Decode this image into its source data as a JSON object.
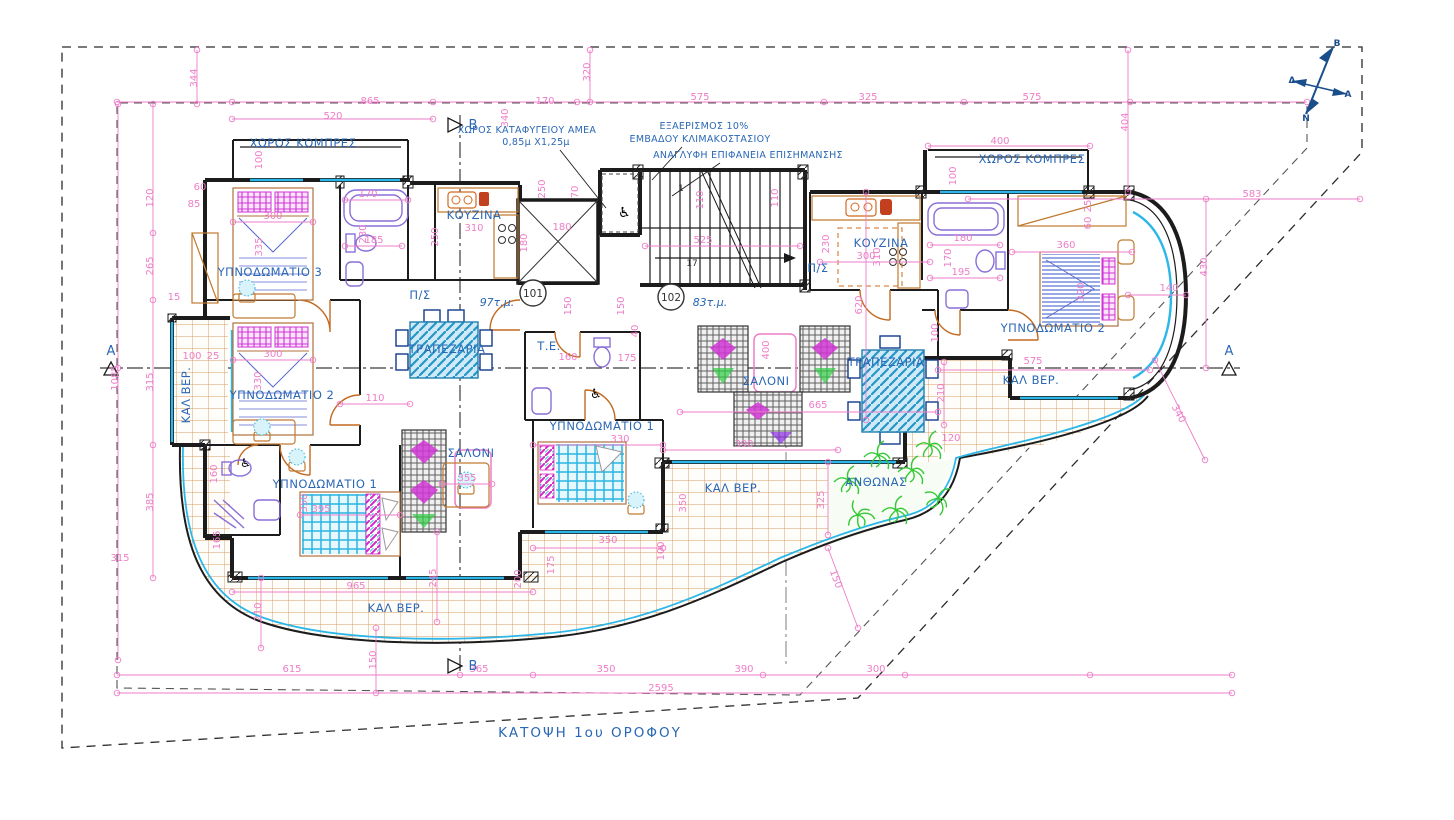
{
  "drawing_title": "ΚΑΤΟΨΗ 1ου ΟΡΟΦΟΥ",
  "apartments": [
    {
      "number": "101",
      "area_label": "97τ.μ."
    },
    {
      "number": "102",
      "area_label": "83τ.μ."
    }
  ],
  "colors": {
    "dimension_pink": "#ee7ec8",
    "label_blue": "#2a67b5",
    "wall_black": "#1c1c1c",
    "glazing_cyan": "#2cb7e8",
    "tile_tan": "#d49a62",
    "plant_green": "#34c934",
    "door_orange": "#c2691f",
    "furniture_magenta": "#cf35d4",
    "table_blue": "#2596c8",
    "compass_navy": "#1a4e8a"
  },
  "compass_letters": [
    {
      "t": "B",
      "x": 1337,
      "y": 46
    },
    {
      "t": "Δ",
      "x": 1292,
      "y": 83
    },
    {
      "t": "A",
      "x": 1348,
      "y": 97
    },
    {
      "t": "N",
      "x": 1306,
      "y": 121
    }
  ],
  "section_markers": [
    {
      "t": "B",
      "x": 473,
      "y": 129
    },
    {
      "t": "B",
      "x": 473,
      "y": 670
    },
    {
      "t": "A",
      "x": 111,
      "y": 355
    },
    {
      "t": "A",
      "x": 1229,
      "y": 355
    }
  ],
  "stair_labels": [
    {
      "t": "1",
      "x": 681,
      "y": 191
    },
    {
      "t": "17",
      "x": 692,
      "y": 266
    }
  ],
  "annotations": [
    {
      "t": "ΧΩΡΟΣ ΚΑΤΑΦΥΓΕΙΟΥ ΑΜΕΑ",
      "x": 527,
      "y": 133
    },
    {
      "t": "0,85μ Χ1,25μ",
      "x": 536,
      "y": 145
    },
    {
      "t": "ΕΞΑΕΡΙΣΜΟΣ 10%",
      "x": 704,
      "y": 129
    },
    {
      "t": "ΕΜΒΑΔΟΥ ΚΛΙΜΑΚΟΣΤΑΣΙΟΥ",
      "x": 700,
      "y": 142
    },
    {
      "t": "ΑΝΑΓΛΥΦΗ ΕΠΙΦΑΝΕΙΑ ΕΠΙΣΗΜΑΝΣΗΣ",
      "x": 748,
      "y": 158
    }
  ],
  "room_labels": [
    {
      "t": "ΧΩΡΟΣ ΚΟΜΠΡΕΣ",
      "x": 303,
      "y": 147
    },
    {
      "t": "ΧΩΡΟΣ ΚΟΜΠΡΕΣ",
      "x": 1032,
      "y": 163
    },
    {
      "t": "ΥΠΝΟΔΩΜΑΤΙΟ 3",
      "x": 270,
      "y": 276
    },
    {
      "t": "ΥΠΝΟΔΩΜΑΤΙΟ 2",
      "x": 282,
      "y": 399
    },
    {
      "t": "ΥΠΝΟΔΩΜΑΤΙΟ 1",
      "x": 325,
      "y": 488
    },
    {
      "t": "ΥΠΝΟΔΩΜΑΤΙΟ 1",
      "x": 602,
      "y": 430
    },
    {
      "t": "ΥΠΝΟΔΩΜΑΤΙΟ 2",
      "x": 1053,
      "y": 332
    },
    {
      "t": "ΚΟΥΖΙΝΑ",
      "x": 474,
      "y": 219
    },
    {
      "t": "ΚΟΥΖΙΝΑ",
      "x": 881,
      "y": 247
    },
    {
      "t": "ΤΡΑΠΕΖΑΡΙΑ",
      "x": 447,
      "y": 353
    },
    {
      "t": "ΤΡΑΠΕΖΑΡΙΑ",
      "x": 886,
      "y": 366
    },
    {
      "t": "ΣΑΛΟΝΙ",
      "x": 471,
      "y": 457
    },
    {
      "t": "ΣΑΛΟΝΙ",
      "x": 766,
      "y": 385
    },
    {
      "t": "ΚΑΛ ΒΕΡ.",
      "x": 190,
      "y": 395,
      "r": -90
    },
    {
      "t": "ΚΑΛ ΒΕΡ.",
      "x": 396,
      "y": 612
    },
    {
      "t": "ΚΑΛ ΒΕΡ.",
      "x": 733,
      "y": 492
    },
    {
      "t": "ΚΑΛ ΒΕΡ.",
      "x": 1031,
      "y": 384
    },
    {
      "t": "ΑΝΘΩΝΑΣ",
      "x": 876,
      "y": 486
    },
    {
      "t": "Τ.Ε.",
      "x": 549,
      "y": 350,
      "s": 10
    },
    {
      "t": "Π/Σ",
      "x": 420,
      "y": 299,
      "s": 9
    },
    {
      "t": "Π/Σ",
      "x": 818,
      "y": 272,
      "s": 9
    }
  ],
  "dimensions": [
    {
      "t": "865",
      "x": 370,
      "y": 104
    },
    {
      "t": "520",
      "x": 333,
      "y": 119
    },
    {
      "t": "344",
      "x": 197,
      "y": 78,
      "r": -90
    },
    {
      "t": "170",
      "x": 545,
      "y": 104
    },
    {
      "t": "340",
      "x": 508,
      "y": 118,
      "r": -90
    },
    {
      "t": "320",
      "x": 590,
      "y": 72,
      "r": -90
    },
    {
      "t": "575",
      "x": 700,
      "y": 100
    },
    {
      "t": "325",
      "x": 868,
      "y": 100
    },
    {
      "t": "575",
      "x": 1032,
      "y": 100
    },
    {
      "t": "400",
      "x": 1000,
      "y": 144
    },
    {
      "t": "404",
      "x": 1128,
      "y": 122,
      "r": -90
    },
    {
      "t": "583",
      "x": 1252,
      "y": 197
    },
    {
      "t": "100",
      "x": 262,
      "y": 160,
      "r": -90
    },
    {
      "t": "100",
      "x": 956,
      "y": 176,
      "r": -90
    },
    {
      "t": "60",
      "x": 200,
      "y": 190,
      "s": 8.5
    },
    {
      "t": "85",
      "x": 194,
      "y": 207,
      "s": 8.5
    },
    {
      "t": "120",
      "x": 153,
      "y": 198,
      "r": -90
    },
    {
      "t": "265",
      "x": 153,
      "y": 266,
      "r": -90
    },
    {
      "t": "315",
      "x": 153,
      "y": 382,
      "r": -90
    },
    {
      "t": "385",
      "x": 153,
      "y": 502,
      "r": -90
    },
    {
      "t": "1085",
      "x": 118,
      "y": 378,
      "r": -90
    },
    {
      "t": "315",
      "x": 120,
      "y": 561
    },
    {
      "t": "170",
      "x": 368,
      "y": 197
    },
    {
      "t": "230",
      "x": 366,
      "y": 234,
      "r": -90
    },
    {
      "t": "185",
      "x": 374,
      "y": 243
    },
    {
      "t": "250",
      "x": 438,
      "y": 237,
      "r": -90
    },
    {
      "t": "310",
      "x": 474,
      "y": 231
    },
    {
      "t": "300",
      "x": 273,
      "y": 219
    },
    {
      "t": "335",
      "x": 262,
      "y": 247,
      "r": -90
    },
    {
      "t": "300",
      "x": 273,
      "y": 357
    },
    {
      "t": "330",
      "x": 261,
      "y": 381,
      "r": -90
    },
    {
      "t": "100",
      "x": 192,
      "y": 359,
      "s": 8.5
    },
    {
      "t": "25",
      "x": 213,
      "y": 359,
      "s": 8.5
    },
    {
      "t": "15",
      "x": 174,
      "y": 300,
      "s": 8.5
    },
    {
      "t": "110",
      "x": 375,
      "y": 401
    },
    {
      "t": "180",
      "x": 562,
      "y": 230
    },
    {
      "t": "180",
      "x": 527,
      "y": 243,
      "r": -90
    },
    {
      "t": "70",
      "x": 578,
      "y": 192,
      "r": -90
    },
    {
      "t": "250",
      "x": 545,
      "y": 189,
      "r": -90
    },
    {
      "t": "525",
      "x": 703,
      "y": 243
    },
    {
      "t": "110",
      "x": 703,
      "y": 200,
      "r": -90
    },
    {
      "t": "110",
      "x": 778,
      "y": 198,
      "r": -90
    },
    {
      "t": "150",
      "x": 571,
      "y": 306,
      "r": -90
    },
    {
      "t": "150",
      "x": 624,
      "y": 306,
      "r": -90
    },
    {
      "t": "160",
      "x": 568,
      "y": 360
    },
    {
      "t": "175",
      "x": 627,
      "y": 361
    },
    {
      "t": "40",
      "x": 638,
      "y": 331,
      "r": -90,
      "s": 8.5
    },
    {
      "t": "230",
      "x": 829,
      "y": 244,
      "r": -90
    },
    {
      "t": "300",
      "x": 866,
      "y": 259
    },
    {
      "t": "310",
      "x": 880,
      "y": 257,
      "r": -90
    },
    {
      "t": "620",
      "x": 862,
      "y": 305,
      "r": -90
    },
    {
      "t": "100",
      "x": 938,
      "y": 333,
      "r": -90
    },
    {
      "t": "195",
      "x": 961,
      "y": 275
    },
    {
      "t": "180",
      "x": 963,
      "y": 241
    },
    {
      "t": "170",
      "x": 951,
      "y": 258,
      "r": -90
    },
    {
      "t": "25",
      "x": 1091,
      "y": 206,
      "r": -90,
      "s": 8
    },
    {
      "t": "60",
      "x": 1091,
      "y": 223,
      "r": -90,
      "s": 8
    },
    {
      "t": "360",
      "x": 1066,
      "y": 248
    },
    {
      "t": "320",
      "x": 1084,
      "y": 292,
      "r": -90
    },
    {
      "t": "140",
      "x": 1169,
      "y": 291
    },
    {
      "t": "430",
      "x": 1207,
      "y": 267,
      "r": -90
    },
    {
      "t": "575",
      "x": 1033,
      "y": 364
    },
    {
      "t": "665",
      "x": 818,
      "y": 408
    },
    {
      "t": "400",
      "x": 769,
      "y": 350,
      "r": -90
    },
    {
      "t": "210",
      "x": 944,
      "y": 393,
      "r": -90
    },
    {
      "t": "120",
      "x": 951,
      "y": 441
    },
    {
      "t": "340",
      "x": 1176,
      "y": 415,
      "r": 62
    },
    {
      "t": "390",
      "x": 744,
      "y": 447
    },
    {
      "t": "325",
      "x": 824,
      "y": 500,
      "r": -90
    },
    {
      "t": "150",
      "x": 833,
      "y": 580,
      "r": 70
    },
    {
      "t": "350",
      "x": 608,
      "y": 543
    },
    {
      "t": "100",
      "x": 664,
      "y": 551,
      "r": -90
    },
    {
      "t": "175",
      "x": 554,
      "y": 565,
      "r": -90
    },
    {
      "t": "200",
      "x": 521,
      "y": 579,
      "r": -90
    },
    {
      "t": "330",
      "x": 620,
      "y": 442
    },
    {
      "t": "350",
      "x": 686,
      "y": 503,
      "r": -90
    },
    {
      "t": "350",
      "x": 307,
      "y": 503,
      "r": -90
    },
    {
      "t": "395",
      "x": 321,
      "y": 512
    },
    {
      "t": "165",
      "x": 220,
      "y": 540,
      "r": -90
    },
    {
      "t": "160",
      "x": 217,
      "y": 474,
      "r": -90
    },
    {
      "t": "355",
      "x": 467,
      "y": 481
    },
    {
      "t": "965",
      "x": 356,
      "y": 589
    },
    {
      "t": "245",
      "x": 436,
      "y": 578,
      "r": -90
    },
    {
      "t": "210",
      "x": 261,
      "y": 612,
      "r": -90
    },
    {
      "t": "615",
      "x": 292,
      "y": 672
    },
    {
      "t": "150",
      "x": 376,
      "y": 660,
      "r": -90
    },
    {
      "t": "365",
      "x": 479,
      "y": 672
    },
    {
      "t": "350",
      "x": 606,
      "y": 672
    },
    {
      "t": "390",
      "x": 744,
      "y": 672
    },
    {
      "t": "300",
      "x": 876,
      "y": 672
    },
    {
      "t": "2595",
      "x": 661,
      "y": 691
    }
  ]
}
